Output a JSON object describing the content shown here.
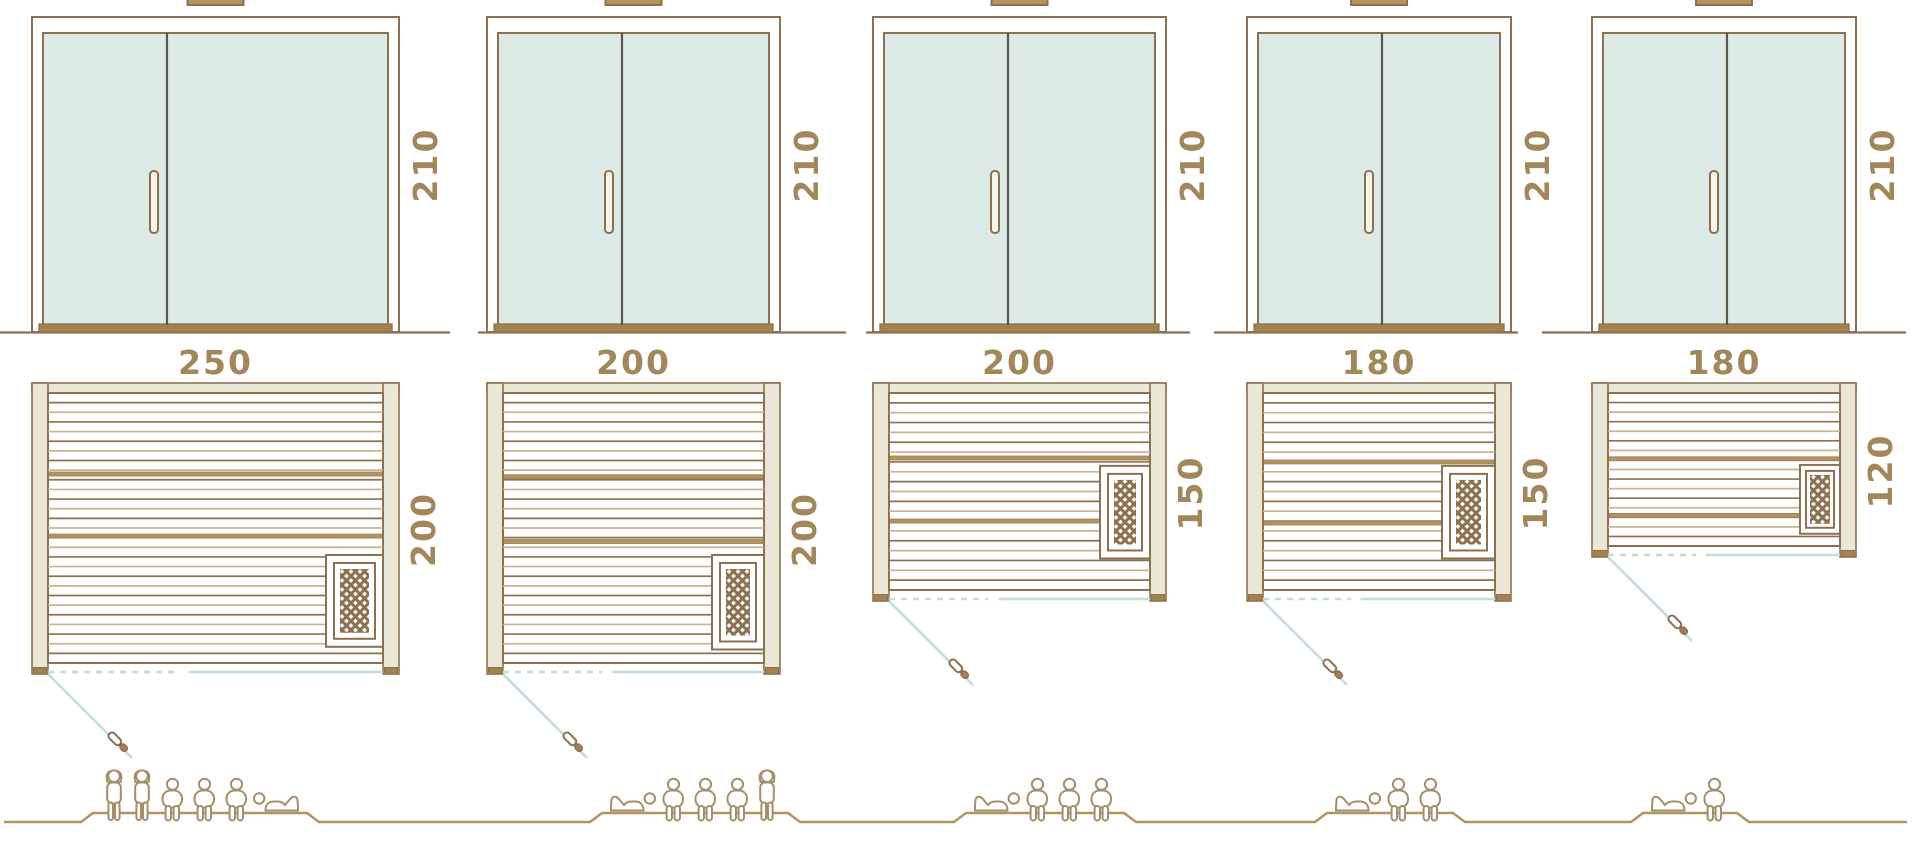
{
  "diagram": {
    "kind": "sauna-size-comparison",
    "rows": [
      "door-elevations",
      "floor-plans",
      "capacity-pictograms"
    ]
  },
  "colors": {
    "outline_brown": "#8d7050",
    "plank_light": "#c9b391",
    "fill_beige": "#eae7d6",
    "wood_brown": "#b3945f",
    "sill_brown": "#a3824e",
    "glass_mint": "#dcebe7",
    "divider_dark": "#5d564c",
    "teal_line": "#c2ded8",
    "label_gold": "#a1875a",
    "people_brown": "#a68e6b",
    "white": "#ffffff"
  },
  "units": [
    {
      "name": "sauna-250x200",
      "elevation": {
        "width_cm": 250,
        "height_cm": 210,
        "height_label": "210"
      },
      "plan": {
        "width_cm": 250,
        "depth_cm": 200,
        "width_label": "250",
        "depth_label": "200"
      },
      "heater": {
        "w": 57,
        "top": 0.6,
        "bottom": 0.94,
        "inset": 8
      },
      "bench_fracs": [
        0.3,
        0.53
      ],
      "capacity": {
        "total": 6,
        "standing": 2,
        "sitting": 3,
        "lying": 1,
        "arrangement": [
          "stand",
          "stand",
          "sit",
          "sit",
          "sit",
          "lie"
        ],
        "lying_head_side": "left"
      }
    },
    {
      "name": "sauna-200x200",
      "elevation": {
        "width_cm": 200,
        "height_cm": 210,
        "height_label": "210"
      },
      "plan": {
        "width_cm": 200,
        "depth_cm": 200,
        "width_label": "200",
        "depth_label": "200"
      },
      "heater": {
        "w": 52,
        "top": 0.6,
        "bottom": 0.95,
        "inset": 8
      },
      "bench_fracs": [
        0.31,
        0.55
      ],
      "capacity": {
        "total": 5,
        "standing": 1,
        "sitting": 3,
        "lying": 1,
        "arrangement": [
          "lie",
          "sit",
          "sit",
          "sit",
          "stand"
        ],
        "lying_head_side": "right"
      }
    },
    {
      "name": "sauna-200x150",
      "elevation": {
        "width_cm": 200,
        "height_cm": 210,
        "height_label": "210"
      },
      "plan": {
        "width_cm": 200,
        "depth_cm": 150,
        "width_label": "200",
        "depth_label": "150"
      },
      "heater": {
        "w": 50,
        "top": 0.37,
        "bottom": 0.84,
        "inset": 8
      },
      "bench_fracs": [
        0.33,
        0.65
      ],
      "capacity": {
        "total": 4,
        "standing": 0,
        "sitting": 3,
        "lying": 1,
        "arrangement": [
          "lie",
          "sit",
          "sit",
          "sit"
        ],
        "lying_head_side": "right"
      }
    },
    {
      "name": "sauna-180x150",
      "elevation": {
        "width_cm": 180,
        "height_cm": 210,
        "height_label": "210"
      },
      "plan": {
        "width_cm": 180,
        "depth_cm": 150,
        "width_label": "180",
        "depth_label": "150"
      },
      "heater": {
        "w": 53,
        "top": 0.37,
        "bottom": 0.84,
        "inset": 8
      },
      "bench_fracs": [
        0.35,
        0.66
      ],
      "capacity": {
        "total": 3,
        "standing": 0,
        "sitting": 2,
        "lying": 1,
        "arrangement": [
          "lie",
          "sit",
          "sit"
        ],
        "lying_head_side": "right"
      }
    },
    {
      "name": "sauna-180x120",
      "elevation": {
        "width_cm": 180,
        "height_cm": 210,
        "height_label": "210"
      },
      "plan": {
        "width_cm": 180,
        "depth_cm": 120,
        "width_label": "180",
        "depth_label": "120"
      },
      "heater": {
        "w": 40,
        "top": 0.47,
        "bottom": 0.92,
        "inset": 6
      },
      "bench_fracs": [
        0.43,
        0.8
      ],
      "capacity": {
        "total": 2,
        "standing": 0,
        "sitting": 1,
        "lying": 1,
        "arrangement": [
          "lie",
          "sit"
        ],
        "lying_head_side": "right"
      }
    }
  ]
}
